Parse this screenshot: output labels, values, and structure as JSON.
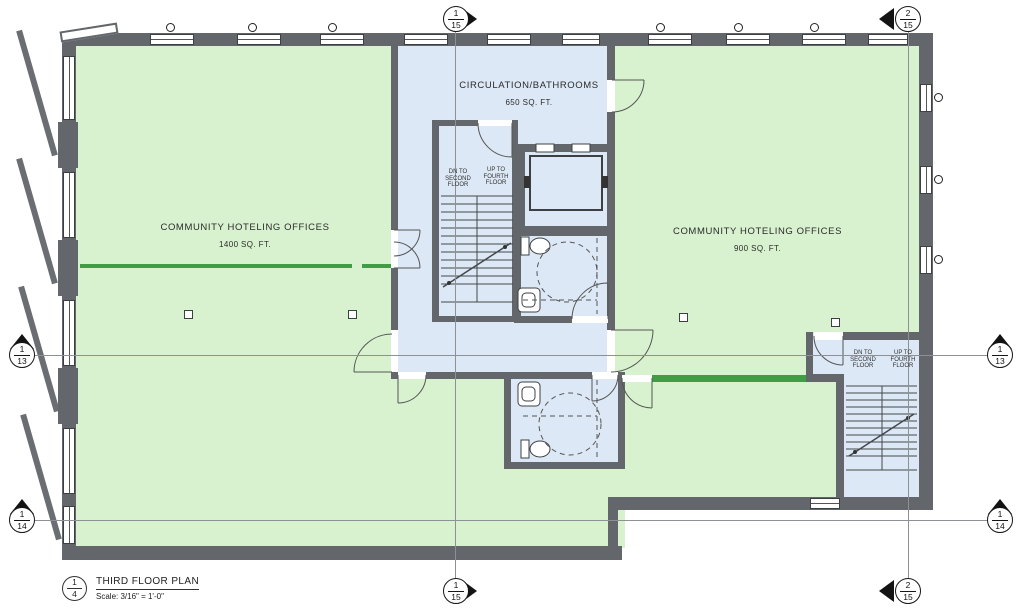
{
  "plan": {
    "rooms": {
      "left_office": {
        "name": "COMMUNITY HOTELING OFFICES",
        "area": "1400 SQ. FT."
      },
      "circulation": {
        "name": "CIRCULATION/BATHROOMS",
        "area": "650 SQ. FT."
      },
      "right_office": {
        "name": "COMMUNITY HOTELING OFFICES",
        "area": "900 SQ. FT."
      }
    },
    "stair_labels": {
      "down": "DN TO SECOND FLOOR",
      "up": "UP TO FOURTH FLOOR"
    },
    "grid_bubbles": {
      "top_left": {
        "num": "1",
        "sheet": "15"
      },
      "top_right": {
        "num": "2",
        "sheet": "15"
      },
      "bottom_left": {
        "num": "1",
        "sheet": "15"
      },
      "bottom_right": {
        "num": "2",
        "sheet": "15"
      },
      "left_mid": {
        "num": "1",
        "sheet": "13"
      },
      "right_mid": {
        "num": "1",
        "sheet": "13"
      },
      "left_low": {
        "num": "1",
        "sheet": "14"
      },
      "right_low": {
        "num": "1",
        "sheet": "14"
      }
    },
    "title_block": {
      "detail": "1",
      "sheet": "4",
      "title": "THIRD FLOOR PLAN",
      "scale": "Scale: 3/16\" = 1'-0\""
    },
    "colors": {
      "wall": "#63676b",
      "office_fill": "#d8f2cf",
      "circulation_fill": "#dce8f5",
      "partition_green": "#3f9e45"
    }
  }
}
